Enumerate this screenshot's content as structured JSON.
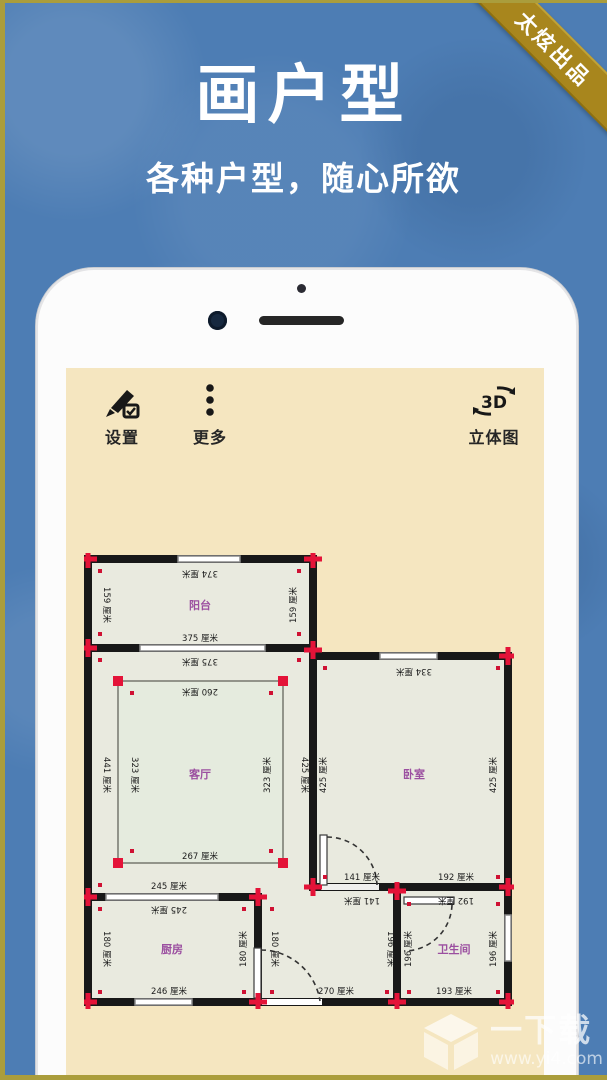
{
  "ribbon": {
    "label": "太炫出品"
  },
  "hero": {
    "title": "画户型",
    "subtitle": "各种户型，随心所欲"
  },
  "phone": {
    "toolbar": {
      "settings_label": "设置",
      "more_label": "更多",
      "view3d_label": "立体图",
      "view3d_icon_text": "3D"
    }
  },
  "floorplan": {
    "unit": "厘米",
    "rooms": {
      "balcony": "阳台",
      "living": "客厅",
      "bedroom": "卧室",
      "kitchen": "厨房",
      "bathroom": "卫生间"
    },
    "dims": {
      "balcony_top": "374 厘米",
      "balcony_left": "159 厘米",
      "balcony_right": "159 厘米",
      "balcony_bottom_above": "375 厘米",
      "balcony_bottom_below": "375 厘米",
      "living_left": "441 厘米",
      "living_right": "425 厘米",
      "bedroom_left": "425 厘米",
      "inner_top": "260 厘米",
      "inner_left": "323 厘米",
      "inner_right": "323 厘米",
      "inner_bottom": "267 厘米",
      "bedroom_top": "334 厘米",
      "bedroom_right": "425 厘米",
      "bed_bottom_left_above": "141 厘米",
      "bed_bottom_left_below": "141 厘米",
      "bed_bottom_right_above": "192 厘米",
      "bed_bottom_right_below": "192 厘米",
      "kitchen_top_above": "245 厘米",
      "kitchen_top_below": "245 厘米",
      "kitchen_left": "180 厘米",
      "kitchen_right": "180 厘米",
      "corridor_left": "180 厘米",
      "kitchen_bottom": "246 厘米",
      "corridor_bottom": "270 厘米",
      "bathroom_left_outer": "196 厘米",
      "bathroom_left_inner": "196 厘米",
      "bathroom_right": "196 厘米",
      "bathroom_bottom": "193 厘米"
    },
    "colors": {
      "wall": "#181818",
      "marker": "#e41338",
      "room_fill": "#e9eadf",
      "label": "#9b4fa0"
    }
  },
  "watermark": {
    "title": "一下载",
    "url": "www.yi4.com"
  }
}
